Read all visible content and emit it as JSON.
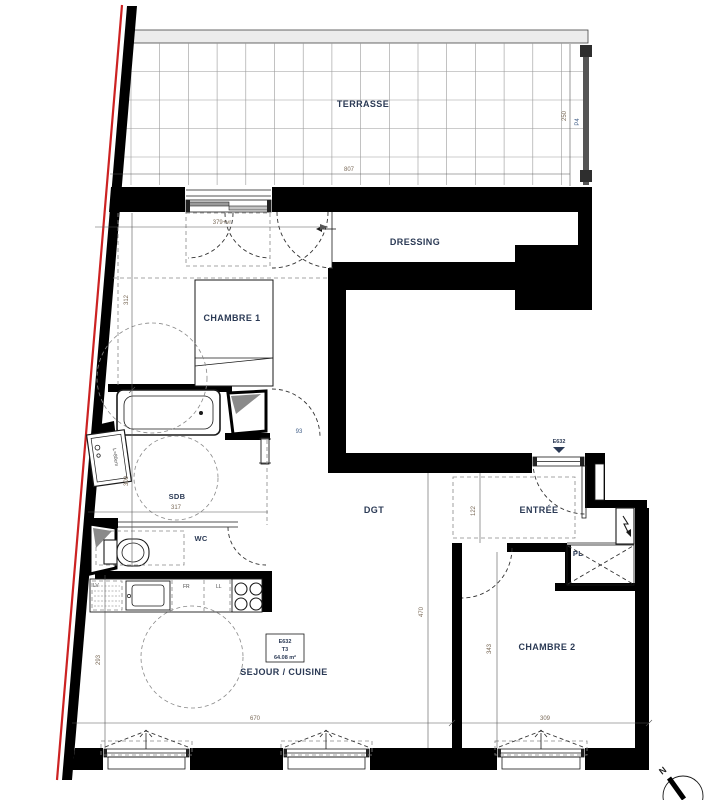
{
  "plan": {
    "rooms": {
      "terrasse": "TERRASSE",
      "dressing": "DRESSING",
      "chambre1": "CHAMBRE 1",
      "sdb": "SDB",
      "wc": "WC",
      "dgt": "DGT",
      "entree": "ENTRÉE",
      "chambre2": "CHAMBRE 2",
      "sejour": "SEJOUR / CUISINE",
      "placard": "PL"
    },
    "unit": {
      "code": "E632",
      "type": "T3",
      "area": "64.08 m²"
    },
    "entry": {
      "code": "E632"
    },
    "dims": {
      "terrace_w": "807",
      "terrace_d": "250",
      "railing": "P4",
      "ch1_window": "379+vr",
      "ch1_h": "312",
      "sdb_h": "309",
      "sdb_w": "317",
      "sdb_door": "93",
      "entree_d": "122",
      "dgt_l": "470",
      "ch2_h": "343",
      "sejour_h": "293",
      "sejour_w": "670",
      "ch2_w": "309"
    },
    "appliances": {
      "lv": "LV",
      "fr": "FR",
      "ll": "LL",
      "vanity": "L=80cm"
    },
    "compass": {
      "n": "N"
    },
    "colors": {
      "wall": "#000000",
      "boundary_red": "#cc2222",
      "label_navy": "#2b3a55",
      "dim_brown": "#7a6a58"
    }
  }
}
